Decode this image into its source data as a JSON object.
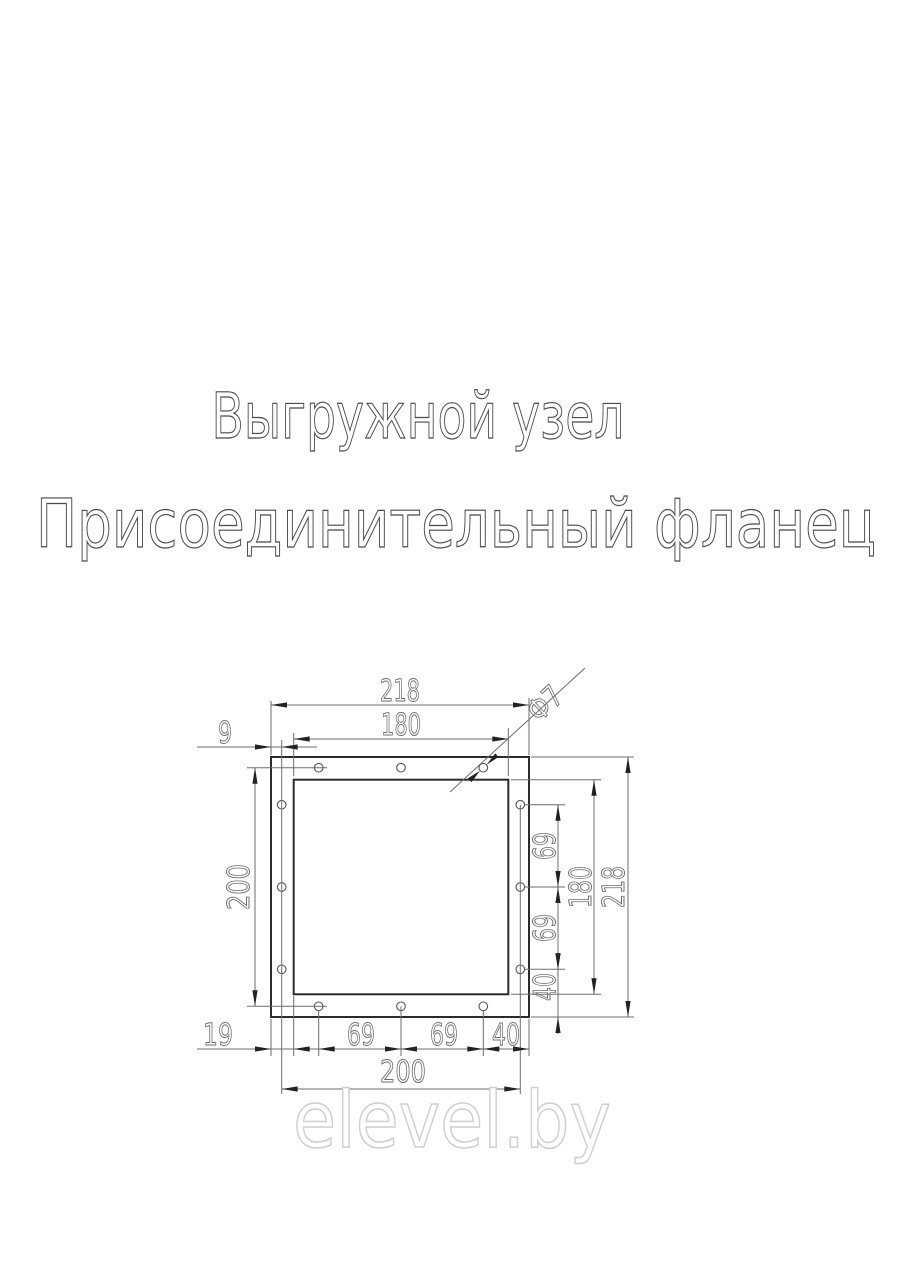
{
  "title": {
    "line1": "Выгружной узел",
    "line2": "Присоединительный фланец"
  },
  "watermark": {
    "text": "elevel.by",
    "color": "#d0d0d0"
  },
  "drawing": {
    "colors": {
      "outline": "#2b2b2b",
      "dimension_lines": "#6e6e6e",
      "dimension_text": "#6e6e6e",
      "title_text": "#4a4a4a"
    },
    "holes": {
      "count": 12,
      "diameter_label": "Ф7"
    },
    "dims": {
      "top_overall": "218",
      "top_inner": "180",
      "top_hole_offset": "9",
      "left_hole_span": "200",
      "right_pitch_upper": "69",
      "right_pitch_lower": "69",
      "right_inner": "180",
      "right_overall": "218",
      "right_corner": "40",
      "bottom_wall": "19",
      "bottom_pitch_left": "69",
      "bottom_pitch_right": "69",
      "bottom_corner": "40",
      "bottom_hole_span": "200",
      "hole_diameter": "Ф7"
    }
  }
}
